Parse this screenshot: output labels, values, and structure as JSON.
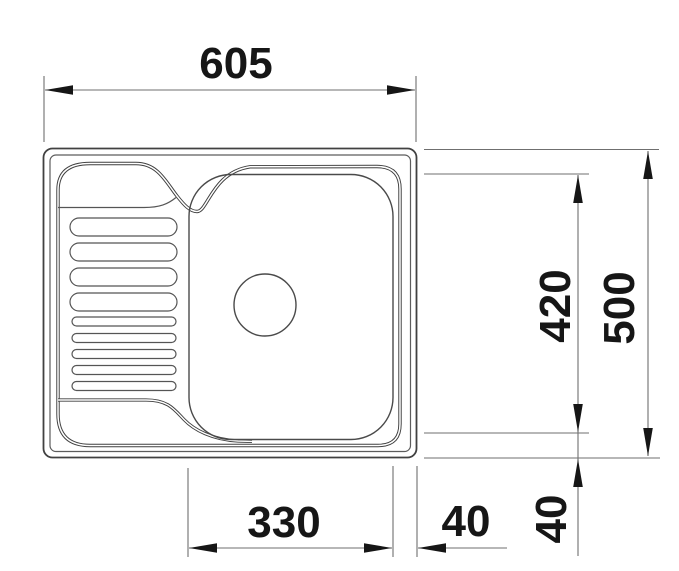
{
  "diagram": {
    "type": "technical-drawing",
    "subject": "kitchen-sink-with-drainboard",
    "view": "top-view",
    "units": "mm"
  },
  "dimensions": {
    "overall_width": "605",
    "overall_depth": "500",
    "bowl_depth": "420",
    "bowl_width": "330",
    "bowl_offset_right": "40",
    "bowl_offset_bottom": "40"
  },
  "colors": {
    "background": "#ffffff",
    "outline": "#414141",
    "dimension_lines": "#6f6f6f",
    "text_and_arrows": "#161616"
  }
}
